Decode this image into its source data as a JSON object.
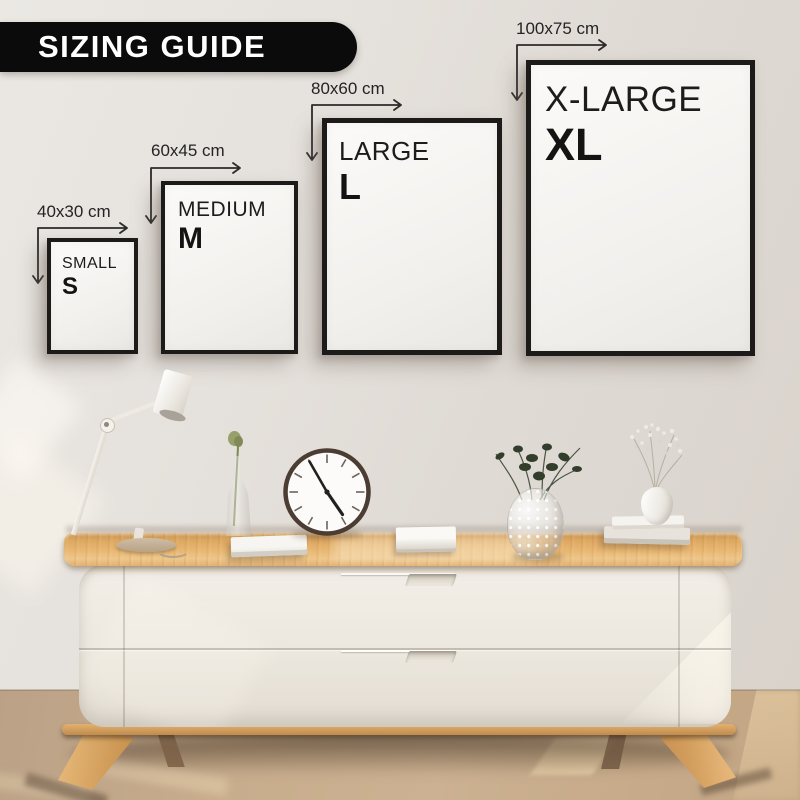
{
  "banner": {
    "title": "SIZING GUIDE"
  },
  "sizes": [
    {
      "name": "SMALL",
      "letter": "S",
      "dimension_label": "40x30 cm"
    },
    {
      "name": "MEDIUM",
      "letter": "M",
      "dimension_label": "60x45 cm"
    },
    {
      "name": "LARGE",
      "letter": "L",
      "dimension_label": "80x60 cm"
    },
    {
      "name": "X-LARGE",
      "letter": "XL",
      "dimension_label": "100x75 cm"
    }
  ],
  "scene": {
    "clock_time_approx": "4:55",
    "decor_items": [
      "white articulated desk lamp",
      "slim glass vase with single green stem",
      "white book",
      "round wall clock",
      "white book",
      "bubble glass vase with dark foliage",
      "white vase with dried flowers on two stacked books"
    ],
    "furniture": "oak-top white sideboard with two drawers and splayed wooden legs"
  },
  "colors": {
    "banner_bg": "#0b0b0b",
    "banner_text": "#ffffff",
    "frame_border": "#1d1b19",
    "label_text": "#242424",
    "wall": "#e0dcd7",
    "wood": "#e2ac66",
    "cabinet_body": "#eee9e1",
    "floor": "#c7ac8c"
  }
}
